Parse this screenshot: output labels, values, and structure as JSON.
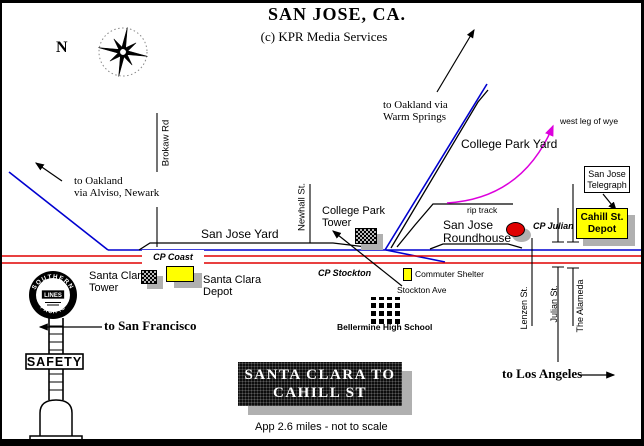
{
  "header": {
    "title": "SAN JOSE, CA.",
    "subtitle": "(c) KPR Media Services"
  },
  "compass": {
    "north": "N"
  },
  "routes": {
    "oakland_alviso": {
      "line1": "to Oakland",
      "line2": "via Alviso, Newark"
    },
    "oakland_warm_springs": {
      "line1": "to Oakland via",
      "line2": "Warm Springs"
    },
    "san_francisco": "to San Francisco",
    "los_angeles": "to Los Angeles",
    "west_leg_of_wye": "west leg of wye"
  },
  "streets": {
    "brokaw": "Brokaw Rd",
    "newhall": "Newhall St.",
    "stockton_ave": "Stockton Ave",
    "lenzen": "Lenzen St.",
    "julian": "Julian St.",
    "the_alameda": "The Alameda"
  },
  "rail": {
    "san_jose_yard": "San Jose Yard",
    "college_park_yard": "College Park Yard",
    "rip_track": "rip track",
    "cp_coast": "CP Coast",
    "cp_stockton": "CP Stockton",
    "cp_julian": "CP Julian",
    "college_park_tower": {
      "line1": "College Park",
      "line2": "Tower"
    },
    "san_jose_roundhouse": {
      "line1": "San Jose",
      "line2": "Roundhouse"
    },
    "santa_clara_tower": {
      "line1": "Santa Clara",
      "line2": "Tower"
    },
    "santa_clara_depot": {
      "line1": "Santa Clara",
      "line2": "Depot"
    },
    "san_jose_telegraph": {
      "line1": "San Jose",
      "line2": "Telegraph"
    },
    "cahill_st_depot": {
      "line1": "Cahill St.",
      "line2": "Depot"
    },
    "commuter_shelter": "Commuter Shelter"
  },
  "landmarks": {
    "bellarmine": "Bellermine High School"
  },
  "banner": {
    "line1": "SANTA CLARA TO",
    "line2": "CAHILL ST",
    "note": "App 2.6 miles - not to scale"
  },
  "sp_totem": {
    "arc_top": "SOUTHERN",
    "arc_bottom": "PACIFIC",
    "center": "LINES",
    "safety": "SAFETY"
  },
  "colors": {
    "main_line_blue": "#0000d0",
    "double_track_red": "#e00000",
    "wye_magenta": "#dd00dd",
    "depot_yellow": "#ffff00",
    "shadow_gray": "#b0b0b0",
    "roundhouse_red": "#e00000"
  }
}
